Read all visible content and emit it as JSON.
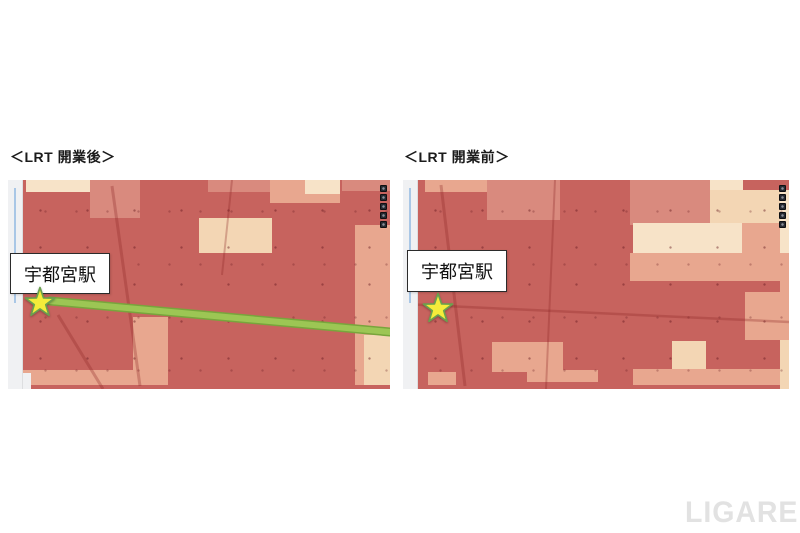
{
  "page": {
    "background": "#ffffff",
    "watermark": "LIGARE"
  },
  "palette": {
    "red_base": "#c7635e",
    "pink": "#d98a7e",
    "salmon": "#e8a78f",
    "cream": "#f3d6b4",
    "cream_light": "#f7e3c8",
    "map_white": "#f0f1f3",
    "river_blue": "#a9c7e6",
    "road_tint": "rgba(140,35,35,0.30)",
    "lrt_green": "#9cc654",
    "lrt_green_dark": "#78a53c",
    "star_yellow": "#f4ec3a",
    "star_outline": "#6aa04e",
    "toolbar_dark": "#262931"
  },
  "panels": [
    {
      "title": "＜LRT 開業後＞",
      "station_label": "宇都宮駅",
      "view": {
        "w": 382,
        "h": 209
      },
      "toolbar_buttons": 5,
      "star": {
        "x": 32,
        "y": 122
      },
      "label_box": {
        "x": 2,
        "y": 73,
        "w": 98,
        "h": 39
      },
      "lrt_line": {
        "x1": 42,
        "y1": 121,
        "x2": 382,
        "y2": 152
      },
      "roads": [
        {
          "x1": 104,
          "y1": 6,
          "x2": 132,
          "y2": 206,
          "w": 3
        },
        {
          "x1": 224,
          "y1": 0,
          "x2": 214,
          "y2": 95,
          "w": 2
        },
        {
          "x1": 50,
          "y1": 135,
          "x2": 95,
          "y2": 209,
          "w": 3
        }
      ],
      "patches": [
        {
          "x": 4.7,
          "y": 0,
          "w": 20.4,
          "h": 5.7,
          "c": "cream_light"
        },
        {
          "x": 21.5,
          "y": 0,
          "w": 13.1,
          "h": 18.2,
          "c": "pink"
        },
        {
          "x": 52.4,
          "y": 0,
          "w": 18.3,
          "h": 5.7,
          "c": "pink"
        },
        {
          "x": 68.6,
          "y": 0,
          "w": 18.3,
          "h": 11.0,
          "c": "salmon"
        },
        {
          "x": 77.7,
          "y": 0,
          "w": 9.2,
          "h": 6.7,
          "c": "cream_light"
        },
        {
          "x": 87.4,
          "y": 0,
          "w": 12.6,
          "h": 5.3,
          "c": "pink"
        },
        {
          "x": 50.0,
          "y": 18.2,
          "w": 19.1,
          "h": 16.7,
          "c": "cream"
        },
        {
          "x": 90.8,
          "y": 21.5,
          "w": 9.2,
          "h": 76.6,
          "c": "salmon"
        },
        {
          "x": 93.2,
          "y": 74.2,
          "w": 6.8,
          "h": 23.9,
          "c": "cream"
        },
        {
          "x": 32.7,
          "y": 65.6,
          "w": 9.2,
          "h": 32.5,
          "c": "salmon"
        },
        {
          "x": 3.9,
          "y": 90.9,
          "w": 28.8,
          "h": 7.2,
          "c": "salmon"
        },
        {
          "x": 0,
          "y": 92.3,
          "w": 6.0,
          "h": 7.7,
          "c": "map_white"
        }
      ]
    },
    {
      "title": "＜LRT 開業前＞",
      "station_label": "宇都宮駅",
      "view": {
        "w": 386,
        "h": 209
      },
      "toolbar_buttons": 5,
      "star": {
        "x": 35,
        "y": 128
      },
      "label_box": {
        "x": 4,
        "y": 70,
        "w": 98,
        "h": 40
      },
      "roads": [
        {
          "x1": 38,
          "y1": 5,
          "x2": 62,
          "y2": 206,
          "w": 3
        },
        {
          "x1": 0,
          "y1": 124,
          "x2": 386,
          "y2": 142,
          "w": 2.5
        },
        {
          "x1": 152,
          "y1": 0,
          "x2": 143,
          "y2": 209,
          "w": 2
        }
      ],
      "patches": [
        {
          "x": 5.7,
          "y": 0,
          "w": 16.8,
          "h": 5.7,
          "c": "salmon"
        },
        {
          "x": 21.8,
          "y": 0,
          "w": 18.9,
          "h": 19.1,
          "c": "pink"
        },
        {
          "x": 58.8,
          "y": 0,
          "w": 21.2,
          "h": 21.5,
          "c": "pink"
        },
        {
          "x": 79.5,
          "y": 0,
          "w": 8.5,
          "h": 5.7,
          "c": "cream_light"
        },
        {
          "x": 79.5,
          "y": 4.8,
          "w": 18.1,
          "h": 15.8,
          "c": "cream"
        },
        {
          "x": 59.6,
          "y": 20.6,
          "w": 28.2,
          "h": 14.4,
          "c": "cream_light"
        },
        {
          "x": 87.8,
          "y": 20.6,
          "w": 9.8,
          "h": 14.4,
          "c": "salmon"
        },
        {
          "x": 58.8,
          "y": 34.9,
          "w": 38.9,
          "h": 13.4,
          "c": "salmon"
        },
        {
          "x": 88.6,
          "y": 53.6,
          "w": 9.1,
          "h": 23.0,
          "c": "salmon"
        },
        {
          "x": 69.7,
          "y": 77.0,
          "w": 8.8,
          "h": 13.4,
          "c": "cream"
        },
        {
          "x": 59.6,
          "y": 90.4,
          "w": 38.1,
          "h": 7.7,
          "c": "salmon"
        },
        {
          "x": 23.1,
          "y": 77.5,
          "w": 18.4,
          "h": 14.4,
          "c": "salmon"
        },
        {
          "x": 32.1,
          "y": 90.9,
          "w": 18.4,
          "h": 5.7,
          "c": "salmon"
        },
        {
          "x": 6.5,
          "y": 91.9,
          "w": 7.3,
          "h": 6.2,
          "c": "salmon"
        },
        {
          "x": 97.7,
          "y": 4.8,
          "w": 2.3,
          "h": 30.2,
          "c": "cream_light"
        },
        {
          "x": 97.7,
          "y": 34.9,
          "w": 2.3,
          "h": 41.6,
          "c": "salmon"
        },
        {
          "x": 97.7,
          "y": 76.6,
          "w": 2.3,
          "h": 23.4,
          "c": "cream"
        }
      ]
    }
  ]
}
